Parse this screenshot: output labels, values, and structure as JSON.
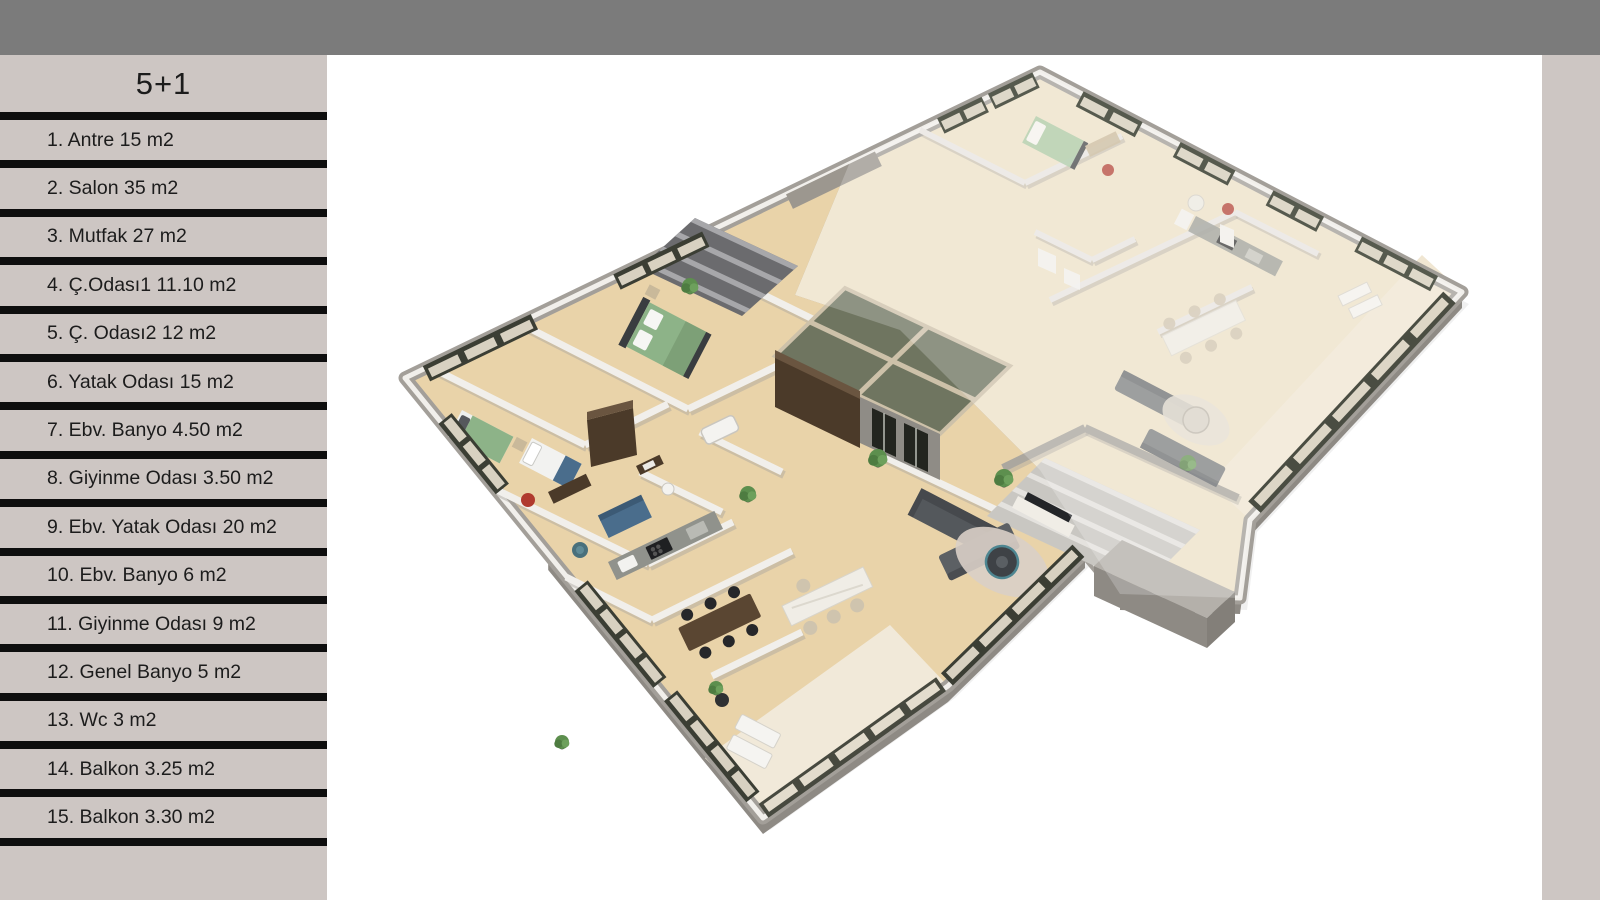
{
  "legend": {
    "title": "5+1",
    "items": [
      {
        "label": "1. Antre 15 m2"
      },
      {
        "label": "2. Salon 35 m2"
      },
      {
        "label": "3. Mutfak 27 m2"
      },
      {
        "label": "4. Ç.Odası1 11.10 m2"
      },
      {
        "label": "5. Ç. Odası2 12 m2"
      },
      {
        "label": "6. Yatak Odası 15 m2"
      },
      {
        "label": "7. Ebv. Banyo 4.50 m2"
      },
      {
        "label": "8. Giyinme Odası 3.50 m2"
      },
      {
        "label": "9. Ebv. Yatak Odası 20 m2"
      },
      {
        "label": "10. Ebv. Banyo 6 m2"
      },
      {
        "label": "11. Giyinme Odası 9 m2"
      },
      {
        "label": "12. Genel Banyo 5 m2"
      },
      {
        "label": "13. Wc 3 m2"
      },
      {
        "label": "14. Balkon 3.25 m2"
      },
      {
        "label": "15. Balkon 3.30 m2"
      }
    ]
  },
  "colors": {
    "top_bar": "#7b7b7b",
    "sidebar_bg": "#cdc6c3",
    "divider": "#0e0e0e",
    "text": "#1c1c1c",
    "canvas": "#ffffff",
    "floor_main": "#e9d3a9",
    "floor_right": "#eee2c8",
    "floor_balcony": "#f1e9d9",
    "wall_outer": "#a39f99",
    "wall_inner": "#f1efeb",
    "wall_shadow": "#aaa69f",
    "wall_right": "#e8e5e0",
    "slab_side": "#8e8a84",
    "core_green": "#6f7560",
    "core_trim": "#cdc1a9",
    "wood_dark": "#4b3a29",
    "stair_dark_floor": "#6b6b6e",
    "stair_dark_step": "#a7a7aa",
    "stair_light_floor": "#c9c7c2",
    "stair_light_step": "#e4e2de",
    "frame_dark": "#3b3e34",
    "glass": "#d8d1c1",
    "sofa_dark": "#54585c",
    "sofa_light": "#74787c",
    "bed_green": "#8db388",
    "bed_dark": "#3a3d40",
    "white_furniture": "#f0ede6",
    "table_wood": "#5a4632",
    "chair_dark": "#26272a",
    "counter": "#90928c",
    "plant": "#5d8f4e",
    "plant_pot": "#2b2d2e",
    "rug": "#d9cfc6",
    "blue": "#4a6d8c",
    "red": "#b03a2e",
    "teal": "#49707c"
  }
}
